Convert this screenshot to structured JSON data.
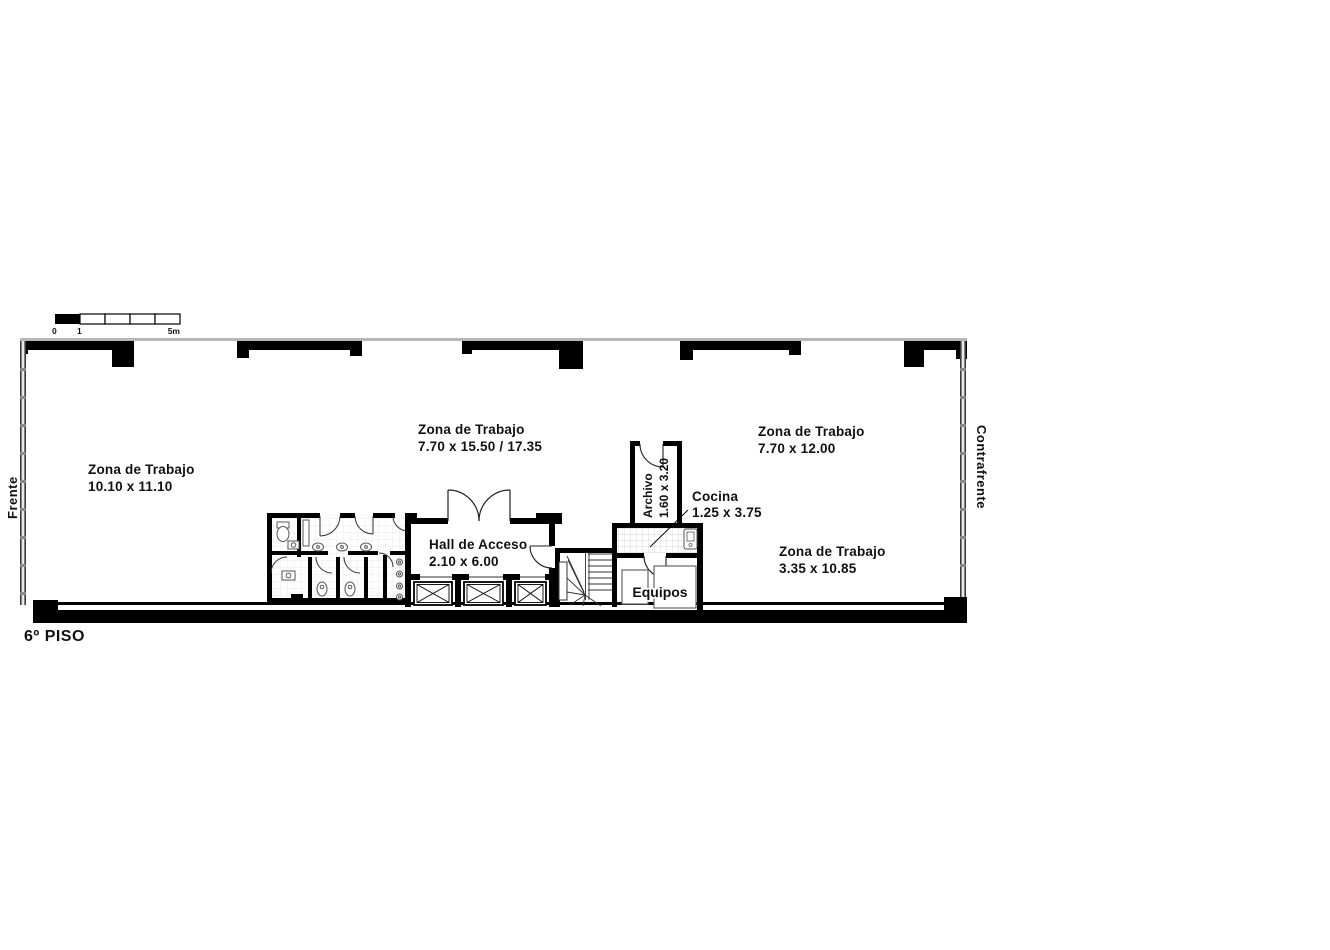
{
  "plan": {
    "floor_label": "6º PISO",
    "side_left": "Frente",
    "side_right": "Contrafrente",
    "scale": {
      "t0": "0",
      "t1": "1",
      "t2": "5m"
    },
    "rooms": {
      "zona1": {
        "name": "Zona de Trabajo",
        "dims": "10.10 x 11.10"
      },
      "zona2": {
        "name": "Zona de Trabajo",
        "dims": "7.70 x 15.50 / 17.35"
      },
      "zona3": {
        "name": "Zona de Trabajo",
        "dims": "7.70 x 12.00"
      },
      "zona4": {
        "name": "Zona de Trabajo",
        "dims": "3.35 x 10.85"
      },
      "hall": {
        "name": "Hall de Acceso",
        "dims": "2.10 x 6.00"
      },
      "archivo": {
        "name": "Archivo",
        "dims": "1.60 x 3.20"
      },
      "cocina": {
        "name": "Cocina",
        "dims": "1.25 x 3.75"
      },
      "equipos": {
        "name": "Equipos"
      }
    },
    "colors": {
      "wall": "#000000",
      "window_line": "#b7b7b7",
      "fixture": "#555555",
      "paper": "#ffffff"
    }
  }
}
